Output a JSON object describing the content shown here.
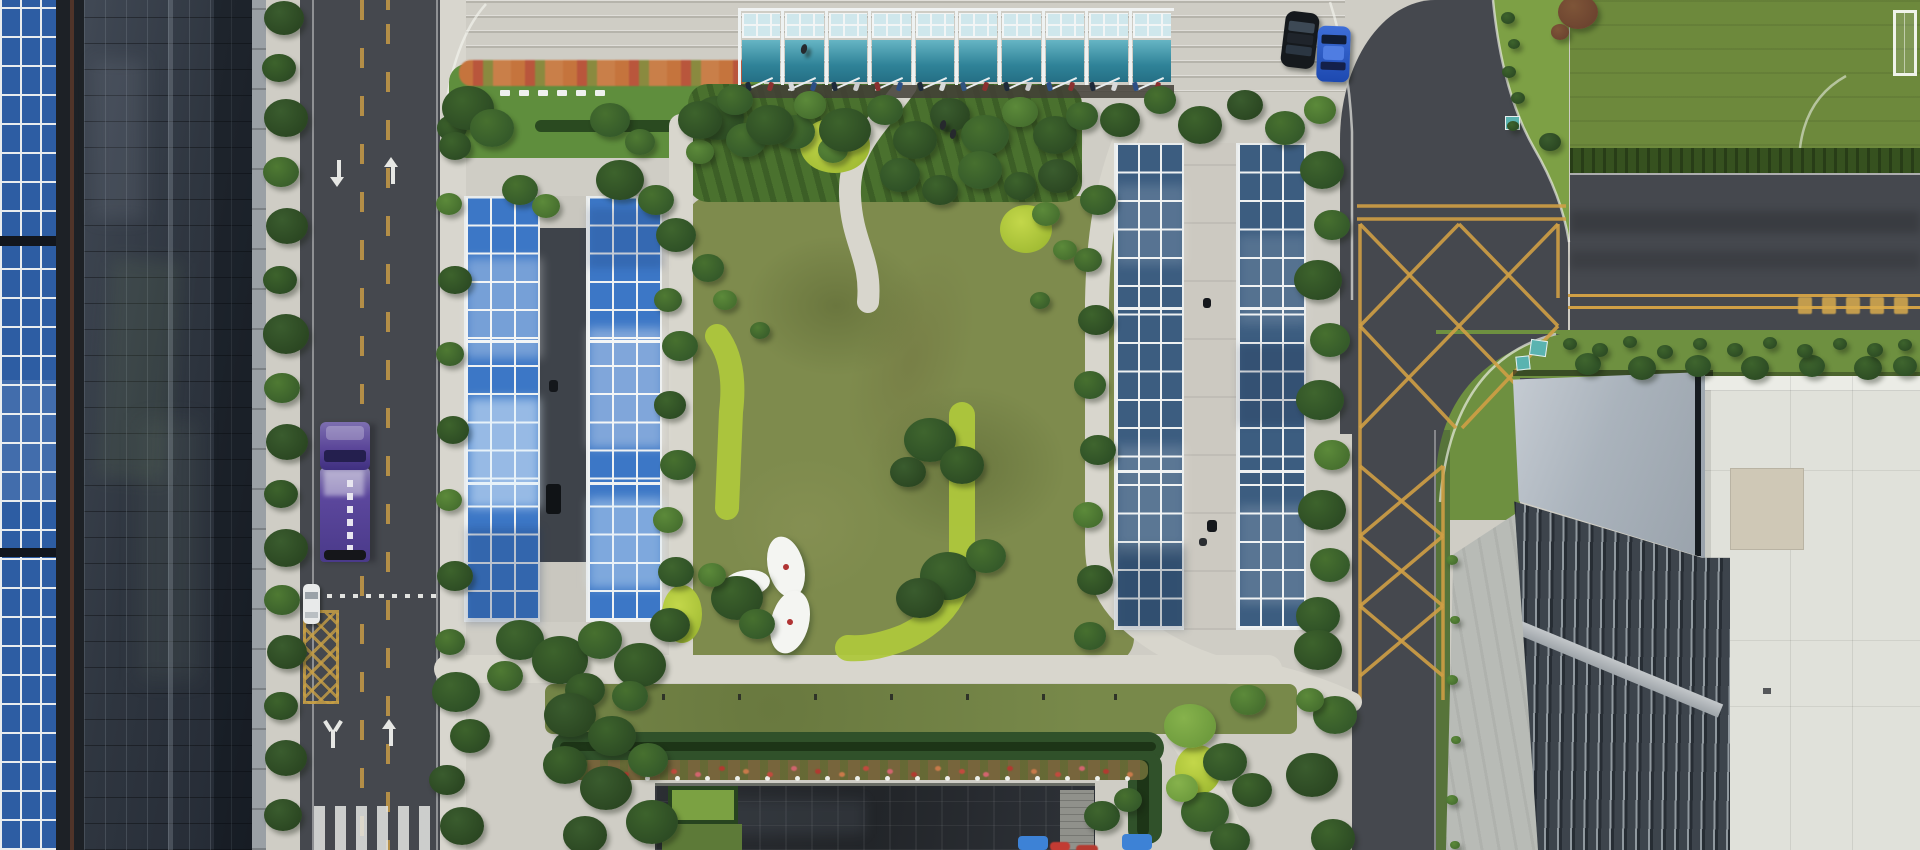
{
  "scene": {
    "type": "aerial-photo",
    "subject": "corporate campus with solar carport canopies, central lawn garden, tree-lined streets and buildings"
  },
  "palette": {
    "concrete": "#cfcdc5",
    "path": "#d8d6cd",
    "sidewalk": "#d8d6ce",
    "asphalt": "#45484e",
    "asphaltDark": "#3c3f45",
    "grass": "#6e9040",
    "lawnOlive": "#7e8b4d",
    "fieldGreen": "#6d893c",
    "hedge": "#30512a",
    "chartreuse": "#aec73c",
    "treeDark": "#2b4722",
    "solarBlue": "#3c77c6",
    "solarSheen": "#a9d0ef",
    "solarDark": "#3c5d80",
    "roofPanelBlue": "#2d5da3",
    "facadeGlass": "#2f3640",
    "canopyTeal": "#3f97ac",
    "canopyPale": "#cfe7ec",
    "yellowLine": "#cf9f45",
    "truckPurple": "#5c429c",
    "carBlue": "#2d5cc8",
    "carBlack": "#15191d",
    "carWhite": "#e8eaea",
    "darkRoof": "#25282c",
    "grayRoof": "#aab2ba",
    "whiteRoof": "#e0e1da",
    "flowerRed": "#c0463b",
    "flowerOrange": "#c5743d",
    "tealBox": "#5ab3b0"
  },
  "treeShades": [
    [
      "#2b4722",
      "#3a5c2e"
    ],
    [
      "#355a2a",
      "#47702f"
    ],
    [
      "#2d4c24",
      "#3d632c"
    ],
    [
      "#3a5f2b",
      "#4f7a33"
    ],
    [
      "#47702f",
      "#5c8a3a"
    ],
    [
      "#6f9c3e",
      "#86b24c"
    ],
    [
      "#2e5026",
      "#3f652e"
    ],
    [
      "#6d4430",
      "#7e5538"
    ]
  ],
  "trees": [
    [
      284,
      18,
      20,
      0
    ],
    [
      279,
      68,
      17,
      2
    ],
    [
      286,
      118,
      22,
      0
    ],
    [
      281,
      172,
      18,
      3
    ],
    [
      287,
      226,
      21,
      0
    ],
    [
      280,
      280,
      17,
      2
    ],
    [
      286,
      334,
      23,
      0
    ],
    [
      282,
      388,
      18,
      3
    ],
    [
      287,
      442,
      21,
      0
    ],
    [
      281,
      494,
      17,
      2
    ],
    [
      286,
      548,
      22,
      0
    ],
    [
      282,
      600,
      18,
      3
    ],
    [
      287,
      652,
      20,
      0
    ],
    [
      281,
      706,
      17,
      2
    ],
    [
      286,
      758,
      21,
      0
    ],
    [
      283,
      815,
      19,
      0
    ],
    [
      452,
      128,
      15,
      2
    ],
    [
      449,
      204,
      13,
      4
    ],
    [
      455,
      280,
      17,
      2
    ],
    [
      450,
      354,
      14,
      3
    ],
    [
      453,
      430,
      16,
      2
    ],
    [
      449,
      500,
      13,
      4
    ],
    [
      455,
      576,
      18,
      2
    ],
    [
      450,
      642,
      15,
      3
    ],
    [
      456,
      692,
      24,
      6
    ],
    [
      470,
      736,
      20,
      2
    ],
    [
      447,
      780,
      18,
      0
    ],
    [
      462,
      826,
      22,
      0
    ],
    [
      468,
      108,
      26,
      2
    ],
    [
      492,
      128,
      22,
      1
    ],
    [
      455,
      146,
      16,
      2
    ],
    [
      610,
      120,
      20,
      1
    ],
    [
      640,
      142,
      15,
      3
    ],
    [
      718,
      118,
      26,
      2
    ],
    [
      746,
      140,
      20,
      1
    ],
    [
      700,
      152,
      14,
      4
    ],
    [
      795,
      132,
      20,
      1
    ],
    [
      833,
      150,
      15,
      4
    ],
    [
      700,
      120,
      22,
      2
    ],
    [
      735,
      100,
      18,
      1
    ],
    [
      770,
      125,
      24,
      2
    ],
    [
      810,
      105,
      16,
      4
    ],
    [
      845,
      130,
      26,
      2
    ],
    [
      885,
      110,
      18,
      1
    ],
    [
      915,
      140,
      22,
      2
    ],
    [
      950,
      115,
      20,
      0
    ],
    [
      985,
      135,
      24,
      1
    ],
    [
      1020,
      112,
      18,
      4
    ],
    [
      1055,
      135,
      22,
      2
    ],
    [
      1082,
      116,
      16,
      1
    ],
    [
      900,
      175,
      20,
      6
    ],
    [
      940,
      190,
      18,
      2
    ],
    [
      980,
      170,
      22,
      1
    ],
    [
      1020,
      186,
      16,
      2
    ],
    [
      1058,
      176,
      20,
      0
    ],
    [
      1046,
      214,
      14,
      4
    ],
    [
      708,
      268,
      16,
      1
    ],
    [
      725,
      300,
      12,
      4
    ],
    [
      760,
      330,
      10,
      3
    ],
    [
      930,
      440,
      26,
      6
    ],
    [
      962,
      465,
      22,
      2
    ],
    [
      908,
      472,
      18,
      0
    ],
    [
      948,
      576,
      28,
      6
    ],
    [
      986,
      556,
      20,
      1
    ],
    [
      920,
      598,
      24,
      0
    ],
    [
      1040,
      300,
      10,
      3
    ],
    [
      1065,
      250,
      12,
      4
    ],
    [
      737,
      598,
      26,
      2
    ],
    [
      757,
      624,
      18,
      1
    ],
    [
      712,
      575,
      14,
      4
    ],
    [
      520,
      190,
      18,
      1
    ],
    [
      546,
      206,
      14,
      4
    ],
    [
      620,
      180,
      24,
      2
    ],
    [
      656,
      200,
      18,
      1
    ],
    [
      676,
      235,
      20,
      6
    ],
    [
      668,
      300,
      14,
      3
    ],
    [
      680,
      346,
      18,
      1
    ],
    [
      670,
      405,
      16,
      2
    ],
    [
      678,
      465,
      18,
      1
    ],
    [
      668,
      520,
      15,
      4
    ],
    [
      676,
      572,
      18,
      6
    ],
    [
      670,
      625,
      20,
      2
    ],
    [
      520,
      640,
      24,
      6
    ],
    [
      560,
      660,
      28,
      2
    ],
    [
      600,
      640,
      22,
      1
    ],
    [
      640,
      665,
      26,
      2
    ],
    [
      505,
      676,
      18,
      3
    ],
    [
      585,
      690,
      20,
      2
    ],
    [
      630,
      696,
      18,
      1
    ],
    [
      570,
      715,
      26,
      0
    ],
    [
      612,
      736,
      24,
      2
    ],
    [
      565,
      765,
      22,
      2
    ],
    [
      606,
      788,
      26,
      0
    ],
    [
      648,
      760,
      20,
      1
    ],
    [
      652,
      822,
      26,
      2
    ],
    [
      585,
      835,
      22,
      0
    ],
    [
      1098,
      200,
      18,
      1
    ],
    [
      1088,
      260,
      14,
      3
    ],
    [
      1096,
      320,
      18,
      2
    ],
    [
      1090,
      385,
      16,
      1
    ],
    [
      1098,
      450,
      18,
      6
    ],
    [
      1088,
      515,
      15,
      4
    ],
    [
      1095,
      580,
      18,
      2
    ],
    [
      1090,
      636,
      16,
      1
    ],
    [
      1322,
      170,
      22,
      6
    ],
    [
      1332,
      225,
      18,
      1
    ],
    [
      1318,
      280,
      24,
      2
    ],
    [
      1330,
      340,
      20,
      1
    ],
    [
      1320,
      400,
      24,
      6
    ],
    [
      1332,
      455,
      18,
      4
    ],
    [
      1322,
      510,
      24,
      2
    ],
    [
      1330,
      565,
      20,
      1
    ],
    [
      1318,
      616,
      22,
      6
    ],
    [
      1120,
      120,
      20,
      2
    ],
    [
      1160,
      100,
      16,
      1
    ],
    [
      1200,
      125,
      22,
      2
    ],
    [
      1245,
      105,
      18,
      0
    ],
    [
      1285,
      128,
      20,
      1
    ],
    [
      1320,
      110,
      16,
      4
    ],
    [
      1190,
      726,
      26,
      5
    ],
    [
      1225,
      762,
      22,
      6
    ],
    [
      1205,
      812,
      24,
      1
    ],
    [
      1248,
      700,
      18,
      4
    ],
    [
      1252,
      790,
      20,
      2
    ],
    [
      1182,
      788,
      16,
      5
    ],
    [
      1230,
      840,
      20,
      6
    ],
    [
      1318,
      650,
      24,
      2
    ],
    [
      1335,
      715,
      22,
      1
    ],
    [
      1312,
      775,
      26,
      0
    ],
    [
      1333,
      838,
      22,
      2
    ],
    [
      1310,
      700,
      14,
      4
    ],
    [
      1102,
      816,
      18,
      6
    ],
    [
      1128,
      800,
      14,
      1
    ],
    [
      1550,
      142,
      11,
      0
    ],
    [
      1578,
      12,
      20,
      7
    ],
    [
      1560,
      32,
      9,
      7
    ],
    [
      1588,
      364,
      13,
      6
    ],
    [
      1642,
      368,
      14,
      2
    ],
    [
      1698,
      366,
      13,
      6
    ],
    [
      1755,
      368,
      14,
      2
    ],
    [
      1812,
      366,
      13,
      6
    ],
    [
      1868,
      368,
      14,
      2
    ],
    [
      1905,
      366,
      12,
      6
    ],
    [
      1452,
      560,
      6,
      4
    ],
    [
      1455,
      620,
      5,
      4
    ],
    [
      1452,
      680,
      6,
      4
    ],
    [
      1456,
      740,
      5,
      4
    ],
    [
      1452,
      800,
      6,
      4
    ],
    [
      1455,
      845,
      5,
      4
    ],
    [
      1508,
      18,
      7,
      2
    ],
    [
      1514,
      44,
      6,
      2
    ],
    [
      1509,
      72,
      7,
      2
    ],
    [
      1518,
      98,
      7,
      2
    ],
    [
      1513,
      126,
      6,
      2
    ],
    [
      1570,
      344,
      7,
      2
    ],
    [
      1600,
      350,
      8,
      2
    ],
    [
      1630,
      342,
      7,
      2
    ],
    [
      1665,
      352,
      8,
      2
    ],
    [
      1700,
      344,
      7,
      2
    ],
    [
      1735,
      350,
      8,
      2
    ],
    [
      1770,
      343,
      7,
      2
    ],
    [
      1805,
      351,
      8,
      2
    ],
    [
      1840,
      344,
      7,
      2
    ],
    [
      1875,
      350,
      8,
      2
    ],
    [
      1905,
      345,
      7,
      2
    ]
  ],
  "solar_arrays": [
    {
      "id": "carport-west-1",
      "x": 464,
      "y": 196,
      "w": 76,
      "h": 426,
      "cols": 3,
      "rows": 15,
      "base": "#3c77c6",
      "sheens": [
        [
          0,
          60,
          76,
          100,
          "rgba(255,255,255,0.30)"
        ],
        [
          2,
          200,
          72,
          110,
          "rgba(225,242,255,0.55)"
        ]
      ],
      "shadows": [
        [
          0,
          330,
          76,
          96,
          "rgba(25,50,100,0.25)"
        ]
      ]
    },
    {
      "id": "carport-west-2",
      "x": 586,
      "y": 196,
      "w": 76,
      "h": 426,
      "cols": 3,
      "rows": 15,
      "base": "#3c77c6",
      "sheens": [
        [
          0,
          130,
          76,
          120,
          "rgba(255,255,255,0.35)"
        ],
        [
          0,
          300,
          76,
          90,
          "rgba(225,242,255,0.40)"
        ]
      ],
      "shadows": [
        [
          0,
          10,
          76,
          60,
          "rgba(25,50,100,0.20)"
        ]
      ]
    },
    {
      "id": "carport-east-1",
      "x": 1114,
      "y": 143,
      "w": 70,
      "h": 487,
      "cols": 3,
      "rows": 17,
      "base": "#3c5d80",
      "sheens": [
        [
          0,
          40,
          70,
          80,
          "rgba(255,255,255,0.14)"
        ],
        [
          0,
          300,
          70,
          110,
          "rgba(255,255,255,0.16)"
        ]
      ],
      "shadows": [
        [
          0,
          400,
          70,
          85,
          "rgba(15,30,55,0.22)"
        ]
      ]
    },
    {
      "id": "carport-east-2",
      "x": 1236,
      "y": 143,
      "w": 70,
      "h": 487,
      "cols": 3,
      "rows": 17,
      "base": "#3c5d80",
      "sheens": [
        [
          0,
          90,
          70,
          90,
          "rgba(255,255,255,0.13)"
        ],
        [
          0,
          360,
          70,
          100,
          "rgba(255,255,255,0.15)"
        ]
      ],
      "shadows": [
        [
          0,
          200,
          70,
          80,
          "rgba(15,30,55,0.18)"
        ]
      ]
    }
  ],
  "canopy": {
    "bays": 10,
    "bay_w": 43.4,
    "x": 738,
    "y": 8,
    "bike_colors": [
      "#1e2a3a",
      "#8a3030",
      "#d8dadb",
      "#2c4f85",
      "#1e2a3a",
      "#caccce",
      "#8a3030",
      "#2c4f85",
      "#1e2a3a",
      "#d8dadb",
      "#31547f",
      "#8a3030",
      "#1e2a3a",
      "#caccce",
      "#2c4f85",
      "#8a3030",
      "#1e2a3a",
      "#d8dadb",
      "#2c4f85",
      "#8a3030"
    ]
  },
  "vehicles": {
    "truck": {
      "x": 318,
      "y": 422
    },
    "white_car": {
      "x": 303,
      "y": 584
    },
    "black_car": {
      "x": 1283,
      "y": 12
    },
    "blue_car": {
      "x": 1317,
      "y": 26
    }
  },
  "garden": {
    "ovals": [
      {
        "x": 768,
        "y": 536,
        "w": 36,
        "h": 62,
        "rot": -14
      },
      {
        "x": 724,
        "y": 570,
        "w": 46,
        "h": 26,
        "rot": -6
      },
      {
        "x": 771,
        "y": 590,
        "w": 38,
        "h": 64,
        "rot": 14
      }
    ],
    "chartreuse_patches": [
      [
        800,
        118,
        70,
        55
      ],
      [
        1000,
        205,
        52,
        48
      ],
      [
        662,
        585,
        40,
        58
      ],
      [
        1175,
        745,
        46,
        50
      ]
    ]
  },
  "bed": {
    "benches": {
      "count": 6,
      "x0": 500,
      "step": 19,
      "y": 90,
      "w": 10,
      "h": 6
    }
  },
  "bottom": {
    "bollards": [
      585,
      662,
      738,
      814,
      890,
      966,
      1042,
      1114
    ],
    "white_dots": {
      "x0": 585,
      "step": 30,
      "count": 19,
      "y": 776
    },
    "flower_dots": {
      "x0": 575,
      "step": 24,
      "count": 24,
      "y": 766,
      "colors": [
        "#c24a3e",
        "#d2656f",
        "#b23a30",
        "#c97a4a"
      ]
    }
  },
  "right_road": {
    "glyphs": {
      "x0": 1798,
      "step": 24,
      "count": 5,
      "y": 297
    }
  },
  "aisle_objects": [
    [
      546,
      484,
      15,
      30,
      "#101316"
    ],
    [
      549,
      380,
      9,
      12,
      "#14171b"
    ]
  ],
  "walkway_objects": [
    [
      1203,
      298,
      8,
      10,
      "#15181c"
    ],
    [
      1207,
      520,
      10,
      12,
      "#15181c"
    ],
    [
      1199,
      538,
      8,
      8,
      "#2a2d31"
    ]
  ]
}
